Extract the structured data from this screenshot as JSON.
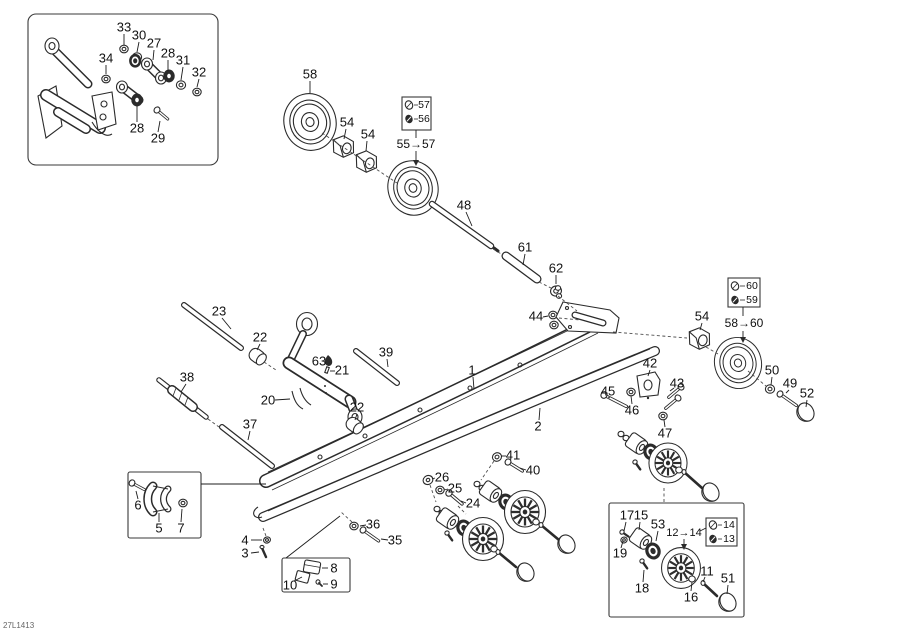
{
  "meta": {
    "drawing_number": "27L1413",
    "background": "#ffffff",
    "line_color": "#2b2b2b",
    "label_color": "#111111"
  },
  "callouts": [
    {
      "t": "33",
      "x": 124,
      "y": 28,
      "l": [
        124,
        34,
        124,
        45
      ]
    },
    {
      "t": "30",
      "x": 139,
      "y": 36,
      "l": [
        139,
        42,
        137,
        52
      ]
    },
    {
      "t": "27",
      "x": 154,
      "y": 44,
      "l": [
        154,
        50,
        153,
        60
      ]
    },
    {
      "t": "28",
      "x": 168,
      "y": 54,
      "l": [
        168,
        60,
        168,
        71
      ]
    },
    {
      "t": "31",
      "x": 183,
      "y": 61,
      "l": [
        183,
        67,
        181,
        80
      ]
    },
    {
      "t": "32",
      "x": 199,
      "y": 73,
      "l": [
        199,
        79,
        197,
        87
      ]
    },
    {
      "t": "34",
      "x": 106,
      "y": 59,
      "l": [
        106,
        65,
        106,
        74
      ]
    },
    {
      "t": "28",
      "x": 137,
      "y": 129,
      "l": [
        137,
        122,
        137,
        106
      ]
    },
    {
      "t": "29",
      "x": 158,
      "y": 139,
      "l": [
        158,
        132,
        160,
        121
      ]
    },
    {
      "t": "58",
      "x": 310,
      "y": 75,
      "l": [
        310,
        81,
        310,
        93
      ]
    },
    {
      "t": "54",
      "x": 347,
      "y": 123,
      "l": [
        346,
        129,
        344,
        139
      ]
    },
    {
      "t": "54",
      "x": 368,
      "y": 135,
      "l": [
        367,
        141,
        366,
        151
      ]
    },
    {
      "t": "57",
      "x": 424,
      "y": 105,
      "fs": 10.5
    },
    {
      "t": "56",
      "x": 424,
      "y": 119,
      "fs": 10.5
    },
    {
      "t": "55→57",
      "x": 416,
      "y": 145,
      "fs": 12
    },
    {
      "t": "48",
      "x": 464,
      "y": 206,
      "l": [
        466,
        212,
        472,
        226
      ]
    },
    {
      "t": "61",
      "x": 525,
      "y": 248,
      "l": [
        525,
        254,
        523,
        265
      ]
    },
    {
      "t": "62",
      "x": 556,
      "y": 269,
      "l": [
        556,
        275,
        556,
        284
      ]
    },
    {
      "t": "44",
      "x": 536,
      "y": 317,
      "l": [
        543,
        317,
        548,
        316
      ]
    },
    {
      "t": "60",
      "x": 752,
      "y": 286,
      "fs": 10.5
    },
    {
      "t": "59",
      "x": 752,
      "y": 300,
      "fs": 10.5
    },
    {
      "t": "58→60",
      "x": 744,
      "y": 324,
      "fs": 12
    },
    {
      "t": "54",
      "x": 702,
      "y": 317,
      "l": [
        702,
        323,
        700,
        330
      ]
    },
    {
      "t": "50",
      "x": 772,
      "y": 371,
      "l": [
        772,
        377,
        771,
        385
      ]
    },
    {
      "t": "49",
      "x": 790,
      "y": 384,
      "l": [
        789,
        390,
        786,
        393
      ]
    },
    {
      "t": "52",
      "x": 807,
      "y": 394,
      "l": [
        807,
        400,
        806,
        407
      ]
    },
    {
      "t": "23",
      "x": 219,
      "y": 312,
      "l": [
        222,
        318,
        231,
        329
      ]
    },
    {
      "t": "22",
      "x": 260,
      "y": 338,
      "l": [
        260,
        344,
        257,
        350
      ]
    },
    {
      "t": "63",
      "x": 319,
      "y": 362
    },
    {
      "t": "21",
      "x": 342,
      "y": 371,
      "l": [
        335,
        371,
        330,
        371
      ]
    },
    {
      "t": "39",
      "x": 386,
      "y": 353,
      "l": [
        387,
        359,
        388,
        367
      ]
    },
    {
      "t": "20",
      "x": 268,
      "y": 401,
      "l": [
        275,
        400,
        290,
        399
      ]
    },
    {
      "t": "38",
      "x": 187,
      "y": 378,
      "l": [
        186,
        384,
        181,
        392
      ]
    },
    {
      "t": "37",
      "x": 250,
      "y": 425,
      "l": [
        250,
        431,
        248,
        440
      ]
    },
    {
      "t": "22",
      "x": 357,
      "y": 408,
      "l": [
        357,
        414,
        355,
        420
      ]
    },
    {
      "t": "1",
      "x": 472,
      "y": 371,
      "l": [
        473,
        377,
        474,
        389
      ]
    },
    {
      "t": "2",
      "x": 538,
      "y": 427,
      "l": [
        539,
        420,
        540,
        408
      ]
    },
    {
      "t": "42",
      "x": 650,
      "y": 364,
      "l": [
        650,
        370,
        648,
        376
      ]
    },
    {
      "t": "43",
      "x": 677,
      "y": 384,
      "l": [
        674,
        388,
        670,
        391
      ]
    },
    {
      "t": "45",
      "x": 608,
      "y": 392,
      "l": [
        608,
        397,
        610,
        398
      ]
    },
    {
      "t": "46",
      "x": 632,
      "y": 411,
      "l": [
        632,
        404,
        631,
        396
      ]
    },
    {
      "t": "47",
      "x": 665,
      "y": 434,
      "l": [
        665,
        427,
        664,
        420
      ]
    },
    {
      "t": "41",
      "x": 513,
      "y": 456,
      "l": [
        506,
        456,
        501,
        456
      ]
    },
    {
      "t": "40",
      "x": 533,
      "y": 471,
      "l": [
        526,
        470,
        520,
        468
      ]
    },
    {
      "t": "26",
      "x": 442,
      "y": 478,
      "l": [
        435,
        478,
        432,
        479
      ]
    },
    {
      "t": "25",
      "x": 455,
      "y": 489,
      "l": [
        448,
        489,
        444,
        490
      ]
    },
    {
      "t": "24",
      "x": 473,
      "y": 504,
      "l": [
        466,
        503,
        461,
        501
      ]
    },
    {
      "t": "36",
      "x": 373,
      "y": 525,
      "l": [
        366,
        525,
        360,
        526
      ]
    },
    {
      "t": "35",
      "x": 395,
      "y": 541,
      "l": [
        388,
        540,
        381,
        539
      ]
    },
    {
      "t": "6",
      "x": 138,
      "y": 506,
      "l": [
        138,
        499,
        136,
        491
      ]
    },
    {
      "t": "5",
      "x": 159,
      "y": 529,
      "l": [
        159,
        522,
        159,
        513
      ]
    },
    {
      "t": "7",
      "x": 181,
      "y": 529,
      "l": [
        181,
        522,
        182,
        509
      ]
    },
    {
      "t": "4",
      "x": 245,
      "y": 541,
      "l": [
        251,
        540,
        262,
        540
      ]
    },
    {
      "t": "3",
      "x": 245,
      "y": 554,
      "l": [
        251,
        553,
        259,
        552
      ]
    },
    {
      "t": "8",
      "x": 334,
      "y": 569,
      "l": [
        328,
        568,
        322,
        568
      ]
    },
    {
      "t": "10",
      "x": 290,
      "y": 586,
      "l": [
        294,
        581,
        302,
        577
      ]
    },
    {
      "t": "9",
      "x": 334,
      "y": 585,
      "l": [
        328,
        584,
        323,
        584
      ]
    },
    {
      "t": "17",
      "x": 627,
      "y": 516,
      "l": [
        626,
        522,
        624,
        531
      ]
    },
    {
      "t": "15",
      "x": 641,
      "y": 516,
      "l": [
        640,
        522,
        639,
        530
      ]
    },
    {
      "t": "53",
      "x": 658,
      "y": 525,
      "l": [
        658,
        531,
        656,
        541
      ]
    },
    {
      "t": "12→14",
      "x": 684,
      "y": 533,
      "fs": 11
    },
    {
      "t": "14",
      "x": 729,
      "y": 525,
      "fs": 10.5
    },
    {
      "t": "13",
      "x": 729,
      "y": 539,
      "fs": 10.5
    },
    {
      "t": "19",
      "x": 620,
      "y": 554,
      "l": [
        621,
        548,
        623,
        541
      ]
    },
    {
      "t": "18",
      "x": 642,
      "y": 589,
      "l": [
        643,
        582,
        644,
        570
      ]
    },
    {
      "t": "16",
      "x": 691,
      "y": 598,
      "l": [
        691,
        591,
        692,
        582
      ]
    },
    {
      "t": "11",
      "x": 707,
      "y": 572,
      "l": [
        705,
        577,
        703,
        582
      ]
    },
    {
      "t": "51",
      "x": 728,
      "y": 579,
      "l": [
        728,
        585,
        727,
        594
      ]
    }
  ]
}
